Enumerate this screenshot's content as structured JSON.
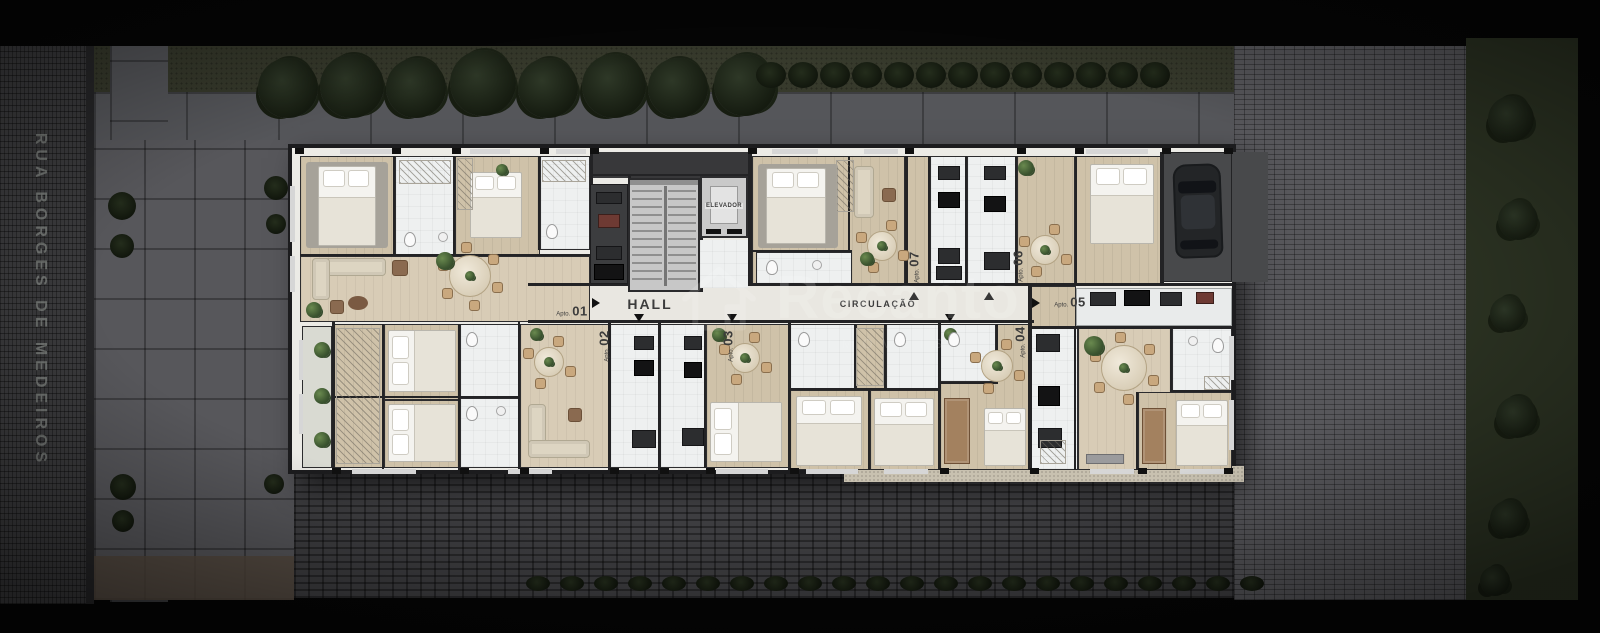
{
  "street": {
    "name": "RUA BORGES DE MEDEIROS"
  },
  "corridor": {
    "hall": "HALL",
    "circulation": "CIRCULAÇÃO"
  },
  "elevator": {
    "label": "ELEVADOR"
  },
  "apartments": [
    {
      "prefix": "Apto.",
      "number": "01"
    },
    {
      "prefix": "Apto.",
      "number": "02"
    },
    {
      "prefix": "Apto.",
      "number": "03"
    },
    {
      "prefix": "Apto.",
      "number": "04"
    },
    {
      "prefix": "Apto.",
      "number": "05"
    },
    {
      "prefix": "Apto.",
      "number": "06"
    },
    {
      "prefix": "Apto.",
      "number": "07"
    }
  ],
  "watermark": {
    "brand": "Recanto",
    "subtitle": "IMÓVEIS",
    "icon": "house-outline-icon"
  },
  "palette": {
    "street_asphalt": "#3a3a3c",
    "ground_green": "#373a2c",
    "pavement": "#55565a",
    "brick_apron": "#3f3f42",
    "brick_right": "#57575b",
    "vegetation": "#2b3222",
    "wood": "#cfc2a9",
    "wood_light": "#d8ccb6",
    "tile": "#eef0f0",
    "hall_floor": "#e9e7e1",
    "wall": "#232325",
    "label_ink": "#3c3c3c",
    "watermark_white": "#ffffff"
  }
}
